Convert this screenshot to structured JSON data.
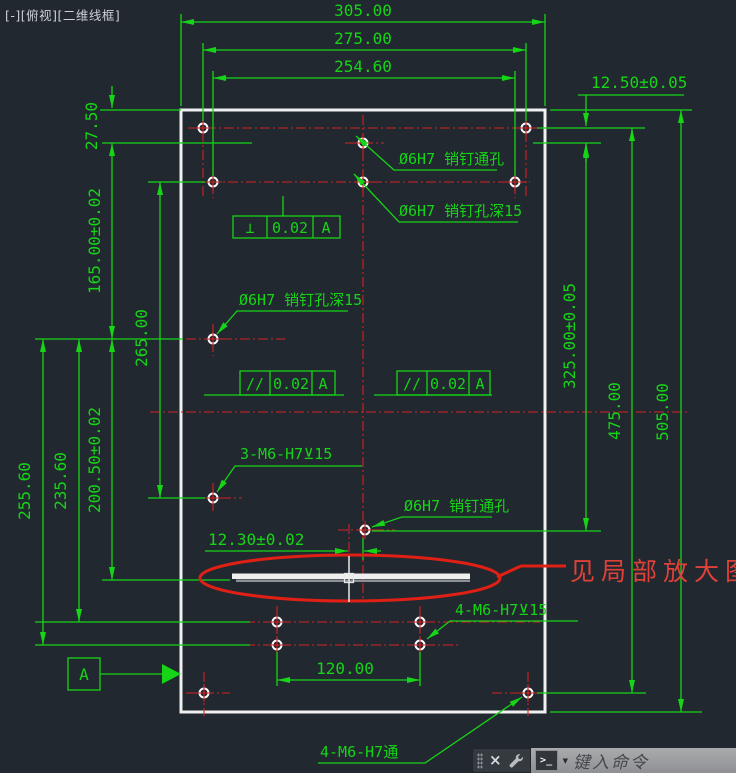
{
  "viewport_controls": {
    "minimize": "[-]",
    "view": "[俯视]",
    "visual_style": "[二维线框]"
  },
  "colors": {
    "background": "#212830",
    "dimension_green": "#16d416",
    "centerline_red": "#d42222",
    "detail_red": "#e02015",
    "note_red": "#e04038",
    "outline_white": "#f0f0f0"
  },
  "dimensions": {
    "width_overall": "305.00",
    "width_pin_row": "275.00",
    "width_second_row": "254.60",
    "right_offset": "12.50±0.05",
    "left_top_offset": "27.50",
    "left_pin_span": "165.00±0.02",
    "left_mid_span": "265.00",
    "left_slot_span": "200.50±0.02",
    "left_lower_span": "235.60",
    "left_bottom_span": "255.60",
    "right_pin_span": "325.00±0.05",
    "right_corner_span": "475.00",
    "height_overall": "505.00",
    "bottom_hole_pitch": "120.00",
    "slot_offset": "12.30±0.02"
  },
  "leaders": {
    "pin_through_top": "Ø6H7 销钉通孔",
    "pin_depth_upper": "Ø6H7 销钉孔深15",
    "pin_depth_mid": "Ø6H7 销钉孔深15",
    "pin_through_bottom": "Ø6H7 销钉通孔",
    "thread_3": "3-M6-H7⊻15",
    "thread_4": "4-M6-H7⊻15",
    "thread_4_through": "4-M6-H7通",
    "detail_note": "见局部放大图"
  },
  "tolerance_frames": [
    {
      "symbol": "⊥",
      "value": "0.02",
      "datum": "A"
    },
    {
      "symbol": "//",
      "value": "0.02",
      "datum": "A"
    },
    {
      "symbol": "//",
      "value": "0.02",
      "datum": "A"
    }
  ],
  "datum_label": "A",
  "command_bar": {
    "close_glyph": "×",
    "prompt_glyph": ">_",
    "dropdown_glyph": "▼",
    "placeholder": "键入命令"
  }
}
